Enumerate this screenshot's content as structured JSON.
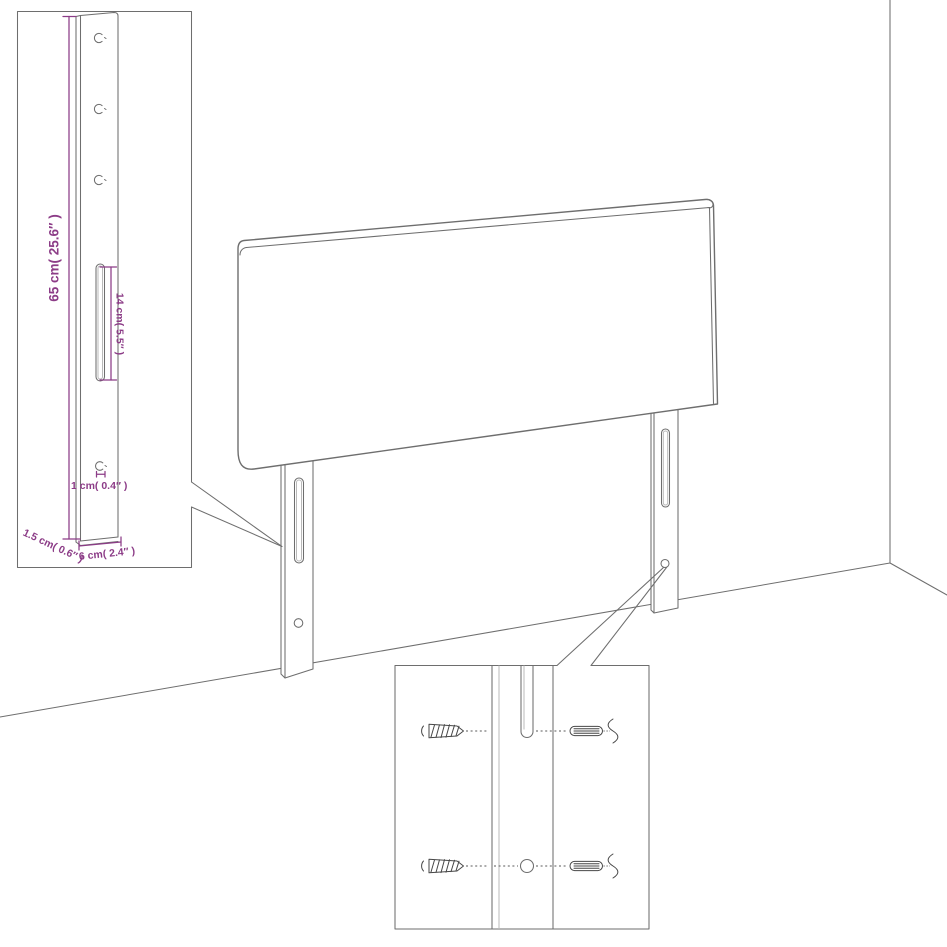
{
  "figure": {
    "background": "#ffffff",
    "line_color": "#6e6e6e",
    "detail_color": "#474747",
    "dim_color": "#8c3c87"
  },
  "dimensions": {
    "leg_height": "65 cm( 25.6″ )",
    "slot_length": "14 cm( 5.5″ )",
    "hole_diameter": "1 cm( 0.4″ )",
    "leg_thickness": "1.5 cm( 0.6″ )",
    "leg_width": "6 cm( 2.4″ )"
  }
}
